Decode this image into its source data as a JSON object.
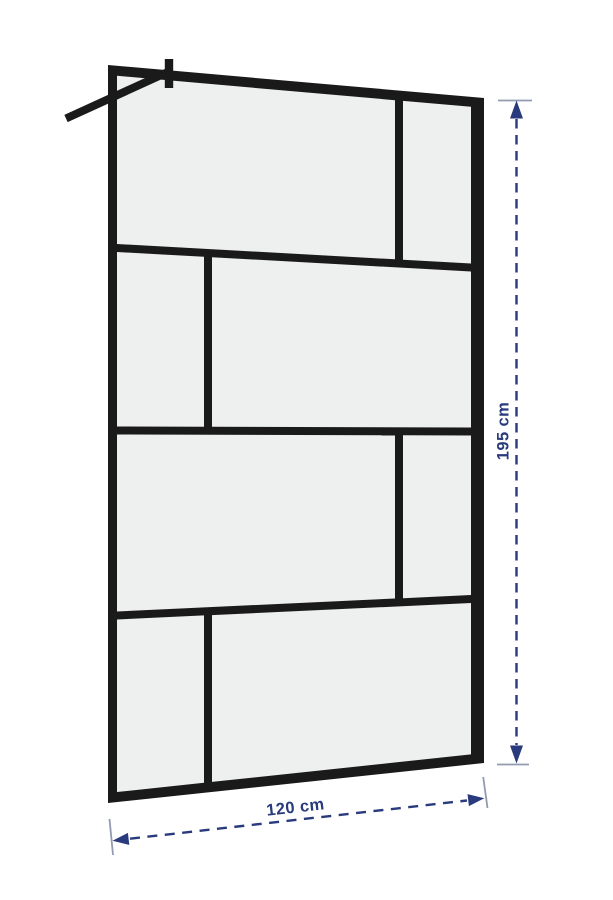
{
  "dimensions": {
    "width_label": "120 cm",
    "height_label": "195 cm"
  },
  "colors": {
    "background": "#ffffff",
    "frame": "#1a1a1a",
    "glass": "#edf0ee",
    "dimension_line": "#293a7d",
    "tick": "#929bb0"
  }
}
